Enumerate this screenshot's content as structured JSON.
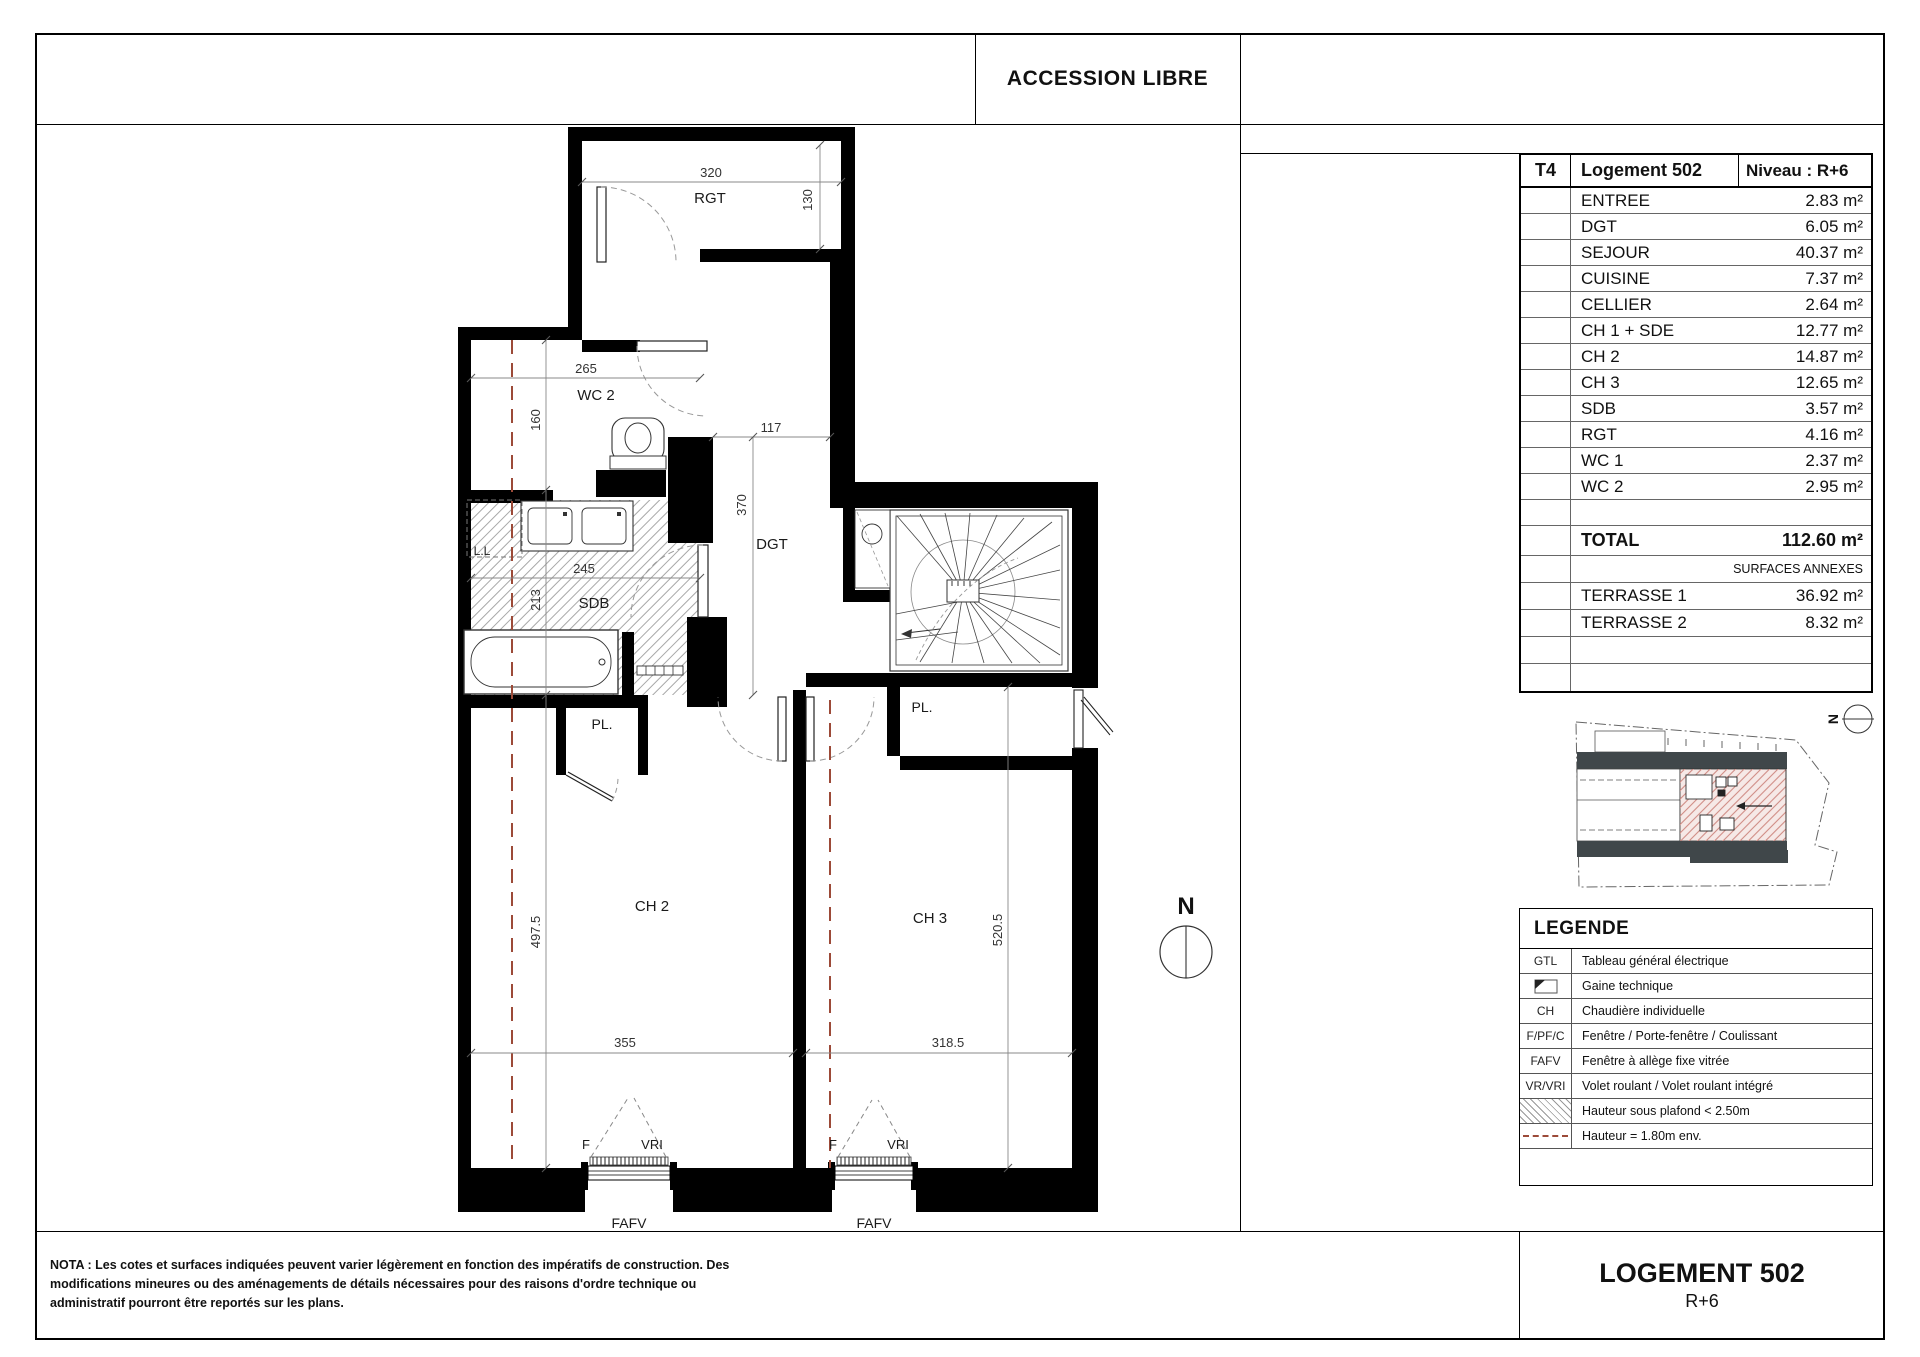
{
  "header": {
    "banner": "ACCESSION LIBRE"
  },
  "unit_table": {
    "type": "T4",
    "unit": "Logement 502",
    "level": "Niveau : R+6",
    "rooms": [
      {
        "name": "ENTREE",
        "area": "2.83 m²"
      },
      {
        "name": "DGT",
        "area": "6.05 m²"
      },
      {
        "name": "SEJOUR",
        "area": "40.37 m²"
      },
      {
        "name": "CUISINE",
        "area": "7.37 m²"
      },
      {
        "name": "CELLIER",
        "area": "2.64 m²"
      },
      {
        "name": "CH 1 + SDE",
        "area": "12.77 m²"
      },
      {
        "name": "CH 2",
        "area": "14.87 m²"
      },
      {
        "name": "CH 3",
        "area": "12.65 m²"
      },
      {
        "name": "SDB",
        "area": "3.57 m²"
      },
      {
        "name": "RGT",
        "area": "4.16 m²"
      },
      {
        "name": "WC 1",
        "area": "2.37 m²"
      },
      {
        "name": "WC 2",
        "area": "2.95 m²"
      }
    ],
    "total_label": "TOTAL",
    "total_area": "112.60 m²",
    "annex_header": "SURFACES ANNEXES",
    "annexes": [
      {
        "name": "TERRASSE 1",
        "area": "36.92 m²"
      },
      {
        "name": "TERRASSE 2",
        "area": "8.32 m²"
      }
    ]
  },
  "legend": {
    "title": "LEGENDE",
    "items": [
      {
        "key": "GTL",
        "label": "Tableau général électrique"
      },
      {
        "key": "",
        "label": "Gaine technique"
      },
      {
        "key": "CH",
        "label": "Chaudière individuelle"
      },
      {
        "key": "F/PF/C",
        "label": "Fenêtre / Porte-fenêtre / Coulissant"
      },
      {
        "key": "FAFV",
        "label": "Fenêtre à allège fixe vitrée"
      },
      {
        "key": "VR/VRI",
        "label": "Volet roulant / Volet roulant intégré"
      },
      {
        "key": "",
        "label": "Hauteur sous plafond < 2.50m"
      },
      {
        "key": "",
        "label": "Hauteur = 1.80m env."
      }
    ]
  },
  "title_block": {
    "title": "LOGEMENT 502",
    "level": "R+6"
  },
  "nota": "NOTA : Les cotes et surfaces indiquées peuvent varier légèrement en fonction des impératifs de construction. Des modifications mineures ou des aménagements de détails nécessaires pour des raisons d'ordre technique ou administratif pourront être reportés sur les plans.",
  "plan": {
    "labels": {
      "rgt": "RGT",
      "wc2": "WC 2",
      "sdb": "SDB",
      "dgt": "DGT",
      "ch2": "CH 2",
      "ch3": "CH 3",
      "pl_ch2": "PL.",
      "pl_ch3": "PL.",
      "ll": "L.L",
      "north": "N",
      "d320": "320",
      "d130": "130",
      "d265": "265",
      "d160": "160",
      "d117": "117",
      "d370": "370",
      "d245": "245",
      "d213": "213",
      "d497": "497.5",
      "d355": "355",
      "d318": "318.5",
      "d520": "520.5",
      "f1": "F",
      "vri1": "VRI",
      "fafv1": "FAFV",
      "f2": "F",
      "vri2": "VRI",
      "fafv2": "FAFV"
    },
    "colors": {
      "wall": "#000000",
      "height_line": "#9c4a38",
      "hatch": "#a8a8a8"
    }
  }
}
